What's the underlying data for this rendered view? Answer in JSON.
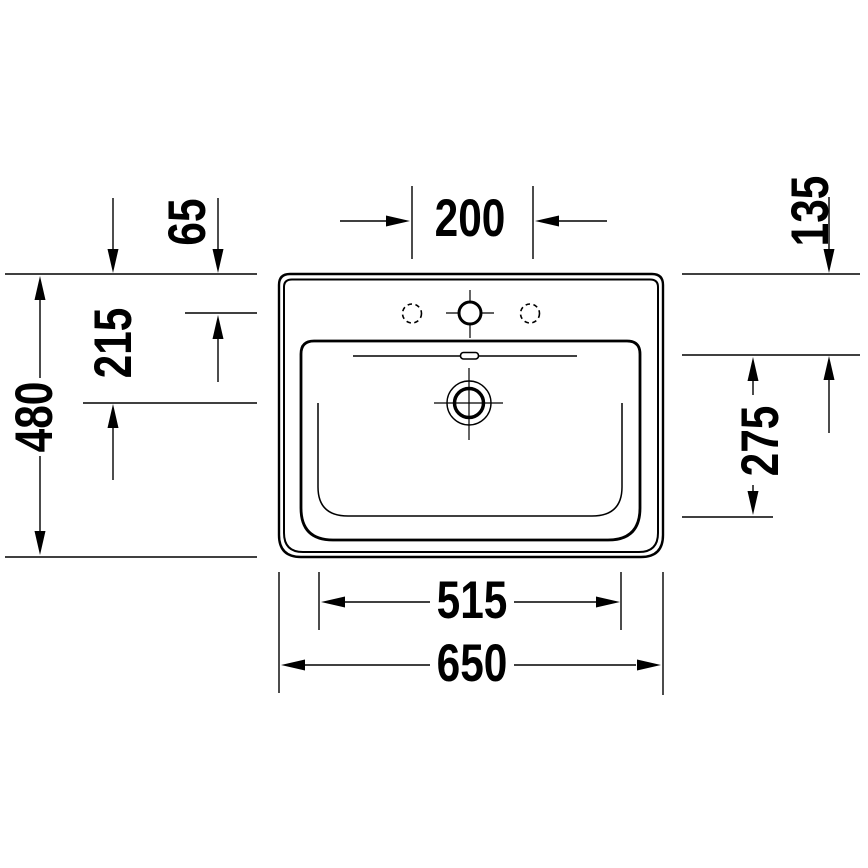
{
  "drawing": {
    "kind": "washbasin-top-view-technical-drawing",
    "line_color": "#000000",
    "background_color": "#ffffff",
    "dimension_labels": {
      "tap_hole_spacing": "200",
      "tap_hole_centerline_from_back": "65",
      "drain_center_from_back": "215",
      "overall_depth": "480",
      "basin_rim_from_back": "135",
      "basin_floor_depth": "275",
      "basin_floor_width": "515",
      "overall_width": "650"
    }
  }
}
